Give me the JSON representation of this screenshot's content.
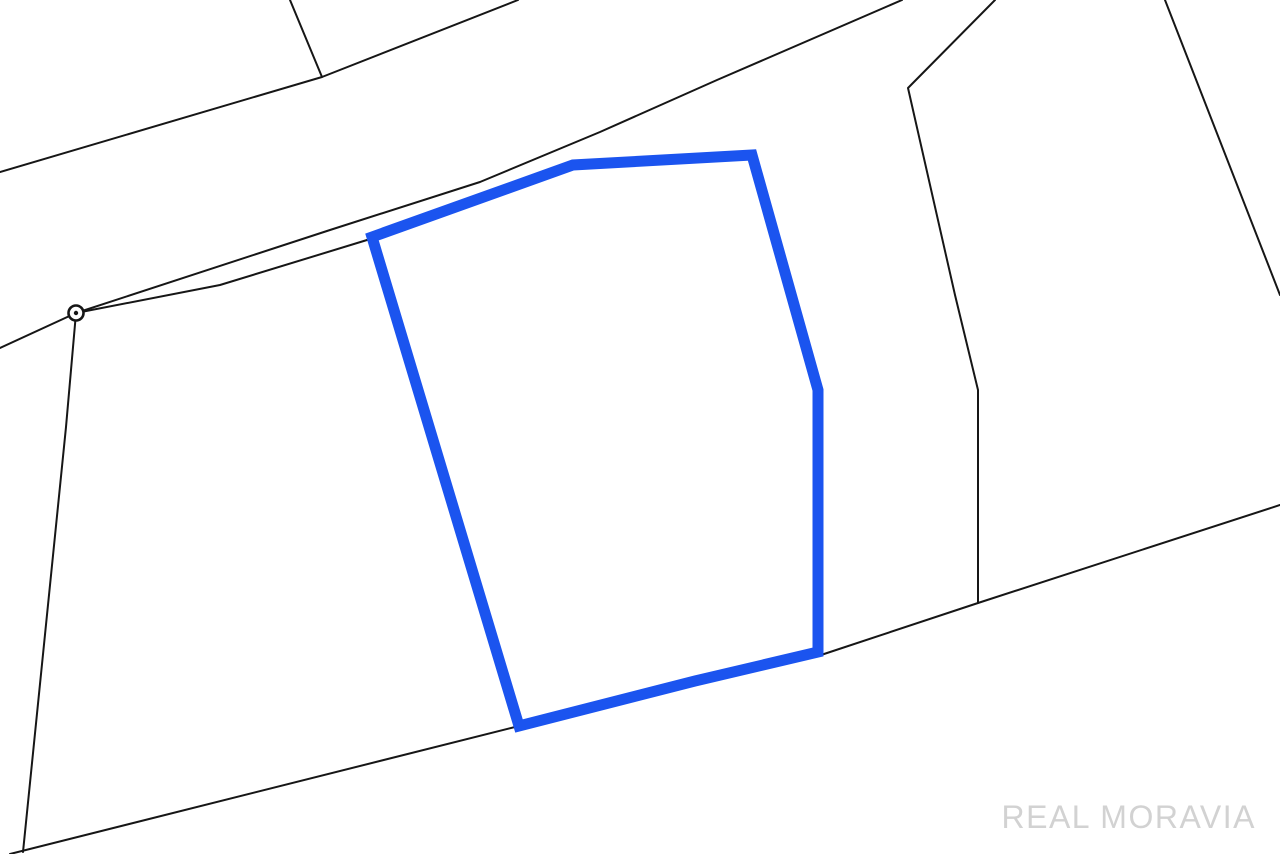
{
  "map": {
    "background_color": "#ffffff",
    "boundary_stroke_color": "#161616",
    "boundary_stroke_width": 2,
    "boundary_lines": [
      {
        "name": "north-parcel-edge",
        "points": [
          [
            0,
            172
          ],
          [
            322,
            77
          ],
          [
            518,
            0
          ]
        ]
      },
      {
        "name": "north-spur",
        "points": [
          [
            290,
            0
          ],
          [
            322,
            77
          ]
        ]
      },
      {
        "name": "road-upper-edge",
        "points": [
          [
            76,
            313
          ],
          [
            330,
            230
          ],
          [
            480,
            182
          ],
          [
            600,
            132
          ],
          [
            717,
            80
          ],
          [
            902,
            0
          ]
        ]
      },
      {
        "name": "road-lower-edge",
        "points": [
          [
            76,
            313
          ],
          [
            220,
            285
          ],
          [
            367,
            240
          ]
        ]
      },
      {
        "name": "road-west-continuation",
        "points": [
          [
            0,
            348
          ],
          [
            76,
            313
          ]
        ]
      },
      {
        "name": "west-boundary",
        "points": [
          [
            76,
            313
          ],
          [
            66,
            427
          ],
          [
            23,
            852
          ]
        ]
      },
      {
        "name": "south-boundary",
        "points": [
          [
            10,
            854
          ],
          [
            519,
            726
          ],
          [
            695,
            683
          ],
          [
            818,
            656
          ],
          [
            978,
            603
          ],
          [
            1280,
            505
          ]
        ]
      },
      {
        "name": "east-inner-boundary",
        "points": [
          [
            995,
            0
          ],
          [
            908,
            88
          ],
          [
            955,
            295
          ],
          [
            978,
            390
          ],
          [
            978,
            603
          ]
        ]
      },
      {
        "name": "east-outer-boundary",
        "points": [
          [
            1165,
            0
          ],
          [
            1280,
            295
          ]
        ]
      }
    ],
    "highlighted_parcel": {
      "color": "#1b54ef",
      "stroke_width": 11,
      "points": [
        [
          372,
          237
        ],
        [
          573,
          165
        ],
        [
          752,
          155
        ],
        [
          818,
          390
        ],
        [
          818,
          652
        ],
        [
          695,
          681
        ],
        [
          519,
          726
        ]
      ]
    },
    "survey_point": {
      "cx": 76,
      "cy": 313,
      "outer_radius": 7.5,
      "ring_stroke_width": 2.6,
      "dot_radius": 2.2,
      "ring_color": "#161616",
      "fill_color": "#ffffff"
    }
  },
  "watermark": {
    "text": "REAL MORAVIA",
    "color": "#d2d2d2"
  }
}
